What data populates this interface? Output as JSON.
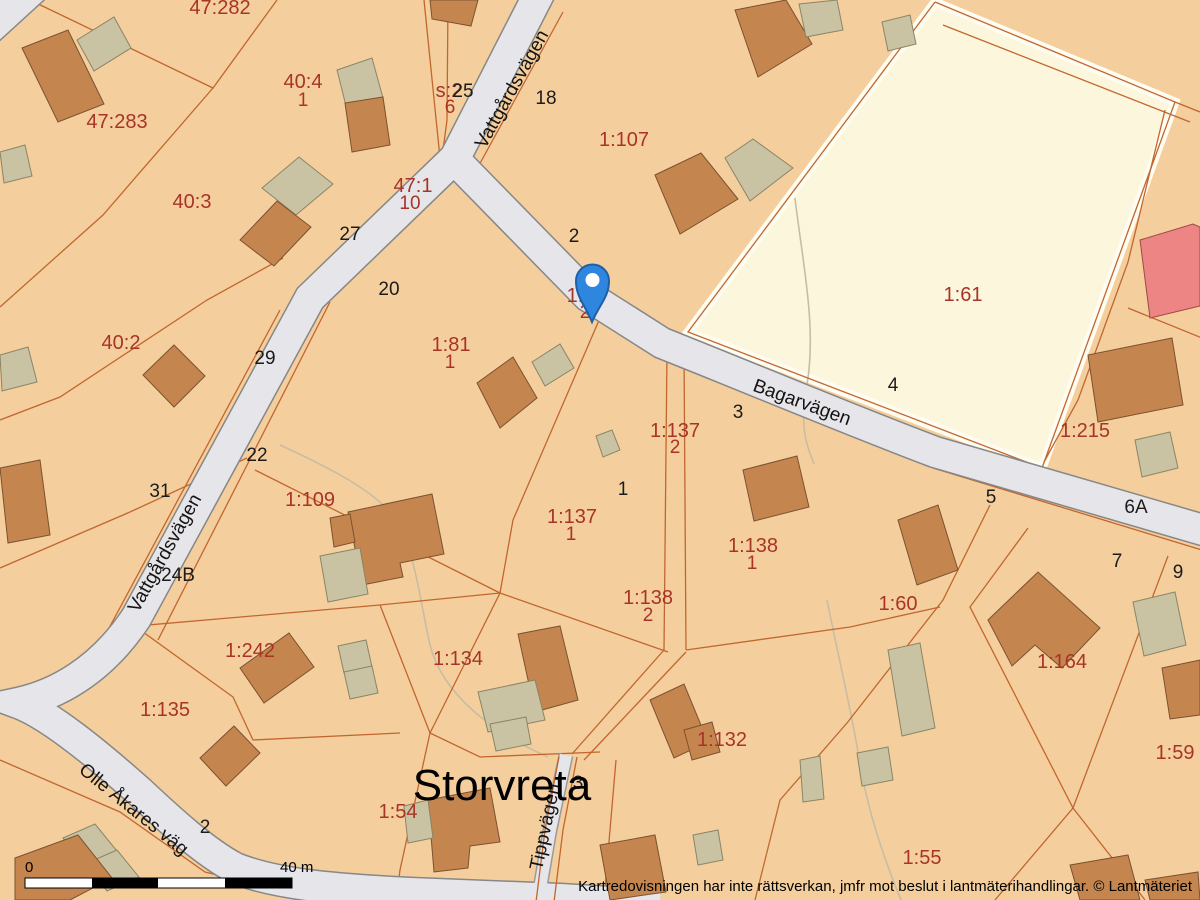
{
  "map": {
    "place": "Storvreta",
    "streets": [
      {
        "name": "Vattgårdsvägen"
      },
      {
        "name": "Vattgårdsvägen"
      },
      {
        "name": "Bagarvägen"
      },
      {
        "name": "Olle Åkares väg"
      },
      {
        "name": "Tippvägen"
      }
    ],
    "parcels": [
      {
        "id": "47:282"
      },
      {
        "id": "47:283"
      },
      {
        "id": "40:4",
        "unit": "1"
      },
      {
        "id": "40:3"
      },
      {
        "id": "40:2"
      },
      {
        "id": "s:2",
        "unit": "6"
      },
      {
        "id": "47:1",
        "unit": "10"
      },
      {
        "id": "1:107"
      },
      {
        "id": "1:61"
      },
      {
        "id": "1:81",
        "unit": "1"
      },
      {
        "id": "1:109"
      },
      {
        "id": "1:137",
        "unit": "2"
      },
      {
        "id": "1:137",
        "unit": "1"
      },
      {
        "id": "1:138",
        "unit": "1"
      },
      {
        "id": "1:138",
        "unit": "2"
      },
      {
        "id": "1:60"
      },
      {
        "id": "1:215"
      },
      {
        "id": "1:164"
      },
      {
        "id": "1:59"
      },
      {
        "id": "1:242"
      },
      {
        "id": "1:135"
      },
      {
        "id": "1:134"
      },
      {
        "id": "1:132"
      },
      {
        "id": "1:54"
      },
      {
        "id": "1:55"
      },
      {
        "id": "1:",
        "unit": "2"
      }
    ],
    "house_numbers": [
      "25",
      "18",
      "2",
      "27",
      "20",
      "29",
      "22",
      "31",
      "24B",
      "2",
      "1",
      "3",
      "4",
      "5",
      "6A",
      "7",
      "9",
      "3"
    ],
    "scale_bar": {
      "start": "0",
      "end": "40 m"
    },
    "disclaimer": "Kartredovisningen har inte rättsverkan, jmfr mot beslut i lantmäterihandlingar. © Lantmäteriet"
  },
  "colors": {
    "land": "#F4CF9D",
    "field": "#FBF6DC",
    "road": "#E6E5E9",
    "building": "#C4854F",
    "outbuilding": "#C9C2A3",
    "highlight_building": "#EE8585",
    "boundary": "#C2662F",
    "parcel_text": "#A83428",
    "marker": "#2E86DF"
  }
}
